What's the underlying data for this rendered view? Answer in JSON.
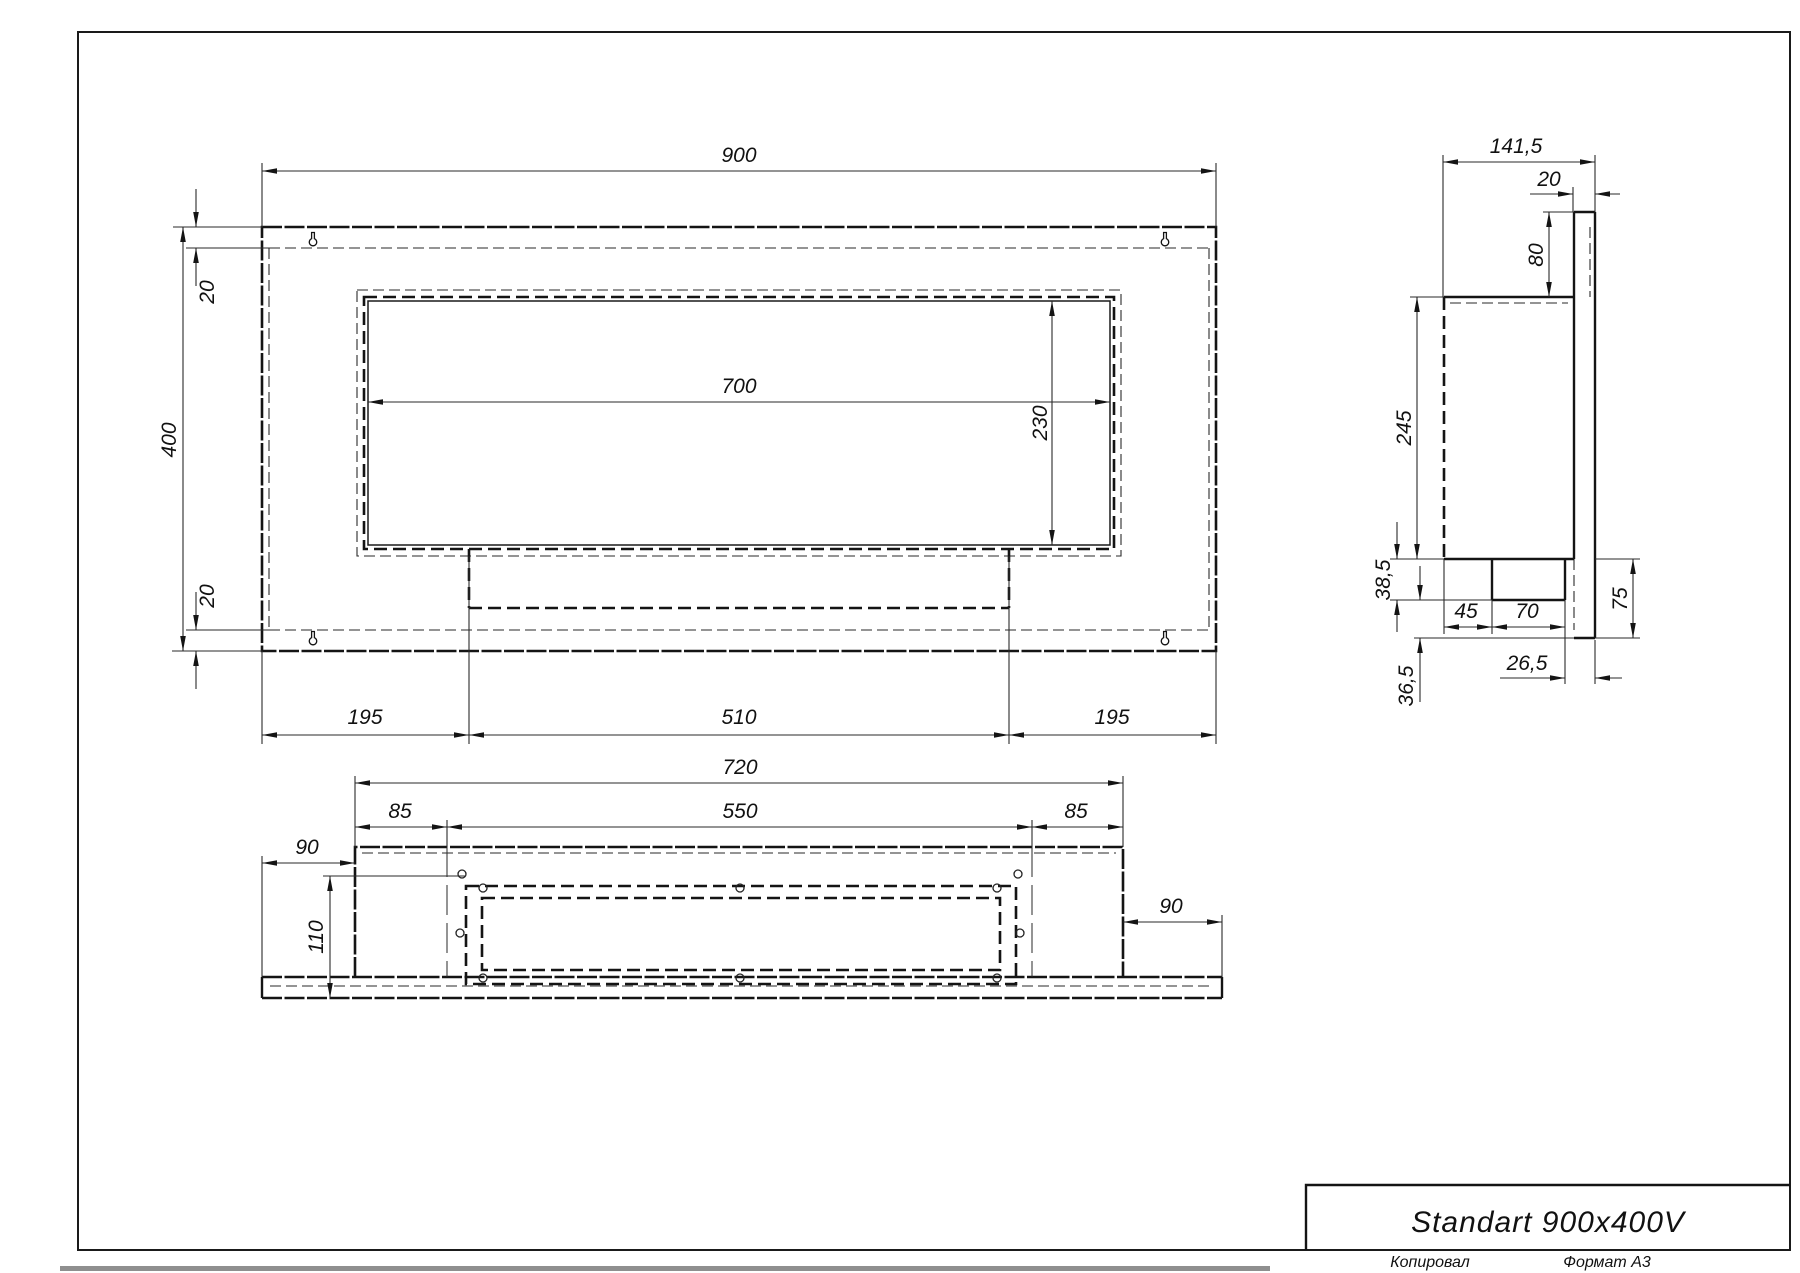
{
  "drawing": {
    "front_view": {
      "width": "900",
      "height": "400",
      "top_inset": "20",
      "bottom_inset": "20",
      "opening_width": "700",
      "opening_height": "230",
      "left_margin": "195",
      "burner_width": "510",
      "right_margin": "195"
    },
    "side_view": {
      "depth": "141,5",
      "panel_thickness": "20",
      "bracket_height": "80",
      "body_height": "245",
      "tray_drop": "38,5",
      "tray_offset": "45",
      "tray_width": "70",
      "lower_height": "75",
      "tray_clearance": "26,5",
      "bottom_drop": "36,5"
    },
    "bottom_view": {
      "body_length": "720",
      "left_inset": "85",
      "hole_span": "550",
      "right_inset": "85",
      "left_overhang": "90",
      "right_overhang": "90",
      "depth": "110"
    },
    "title_block": {
      "model": "Standart 900x400V",
      "copied_by": "Копировал",
      "format": "Формат А3"
    }
  }
}
